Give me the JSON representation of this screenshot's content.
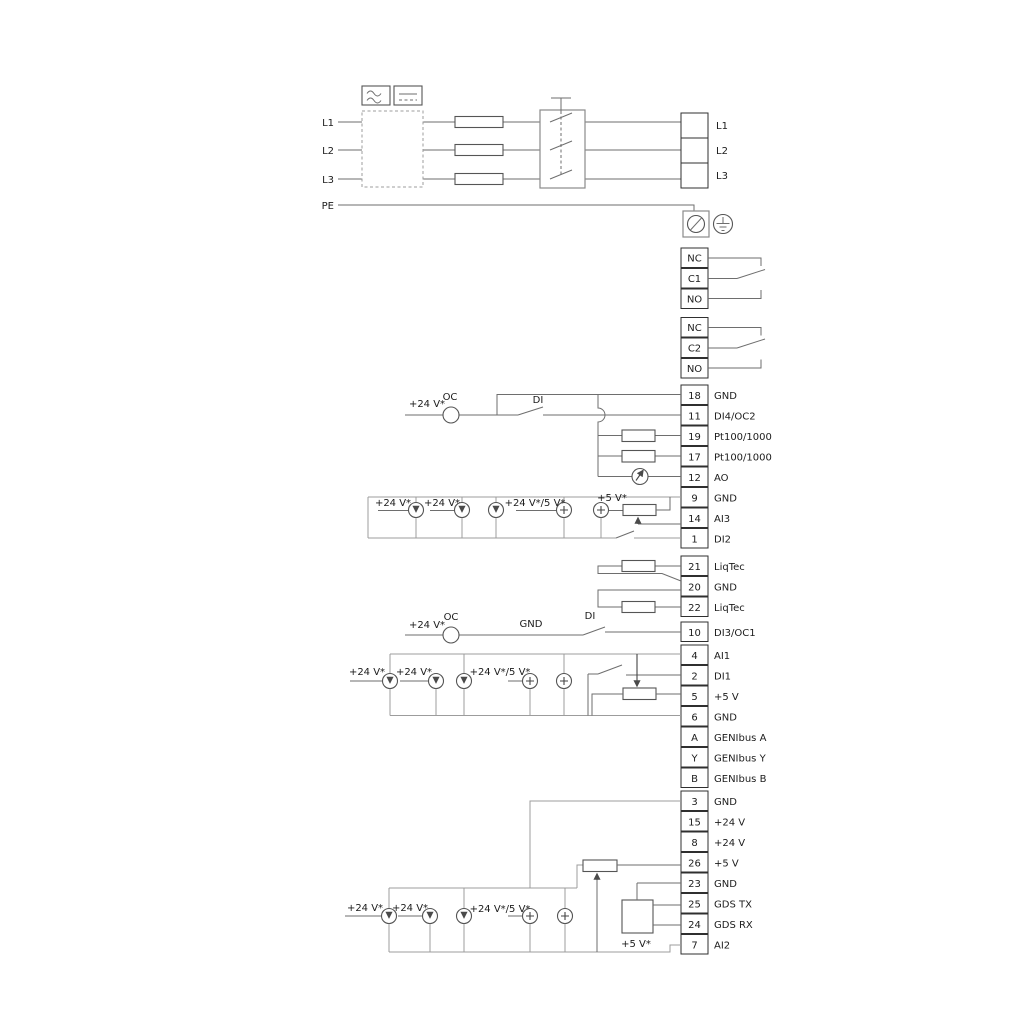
{
  "mains": {
    "input_labels": [
      "L1",
      "L2",
      "L3",
      "PE"
    ],
    "output_labels": [
      "L1",
      "L2",
      "L3"
    ]
  },
  "relays": {
    "r1": [
      "NC",
      "C1",
      "NO"
    ],
    "r2": [
      "NC",
      "C2",
      "NO"
    ]
  },
  "terminals": {
    "io_top": [
      {
        "num": "18",
        "label": "GND"
      },
      {
        "num": "11",
        "label": "DI4/OC2"
      },
      {
        "num": "19",
        "label": "Pt100/1000"
      },
      {
        "num": "17",
        "label": "Pt100/1000"
      },
      {
        "num": "12",
        "label": "AO"
      }
    ],
    "io_ai3": [
      {
        "num": "9",
        "label": "GND"
      },
      {
        "num": "14",
        "label": "AI3"
      },
      {
        "num": "1",
        "label": "DI2"
      }
    ],
    "io_liqtec": [
      {
        "num": "21",
        "label": "LiqTec"
      },
      {
        "num": "20",
        "label": "GND"
      },
      {
        "num": "22",
        "label": "LiqTec"
      }
    ],
    "io_di3": [
      {
        "num": "10",
        "label": "DI3/OC1"
      }
    ],
    "io_ai1": [
      {
        "num": "4",
        "label": "AI1"
      },
      {
        "num": "2",
        "label": "DI1"
      },
      {
        "num": "5",
        "label": "+5 V"
      },
      {
        "num": "6",
        "label": "GND"
      },
      {
        "num": "A",
        "label": "GENIbus A"
      },
      {
        "num": "Y",
        "label": "GENIbus Y"
      },
      {
        "num": "B",
        "label": "GENIbus B"
      }
    ],
    "io_ai2": [
      {
        "num": "3",
        "label": "GND"
      },
      {
        "num": "15",
        "label": "+24 V"
      },
      {
        "num": "8",
        "label": "+24 V"
      },
      {
        "num": "26",
        "label": "+5 V"
      },
      {
        "num": "23",
        "label": "GND"
      },
      {
        "num": "25",
        "label": "GDS TX"
      },
      {
        "num": "24",
        "label": "GDS RX"
      },
      {
        "num": "7",
        "label": "AI2"
      }
    ]
  },
  "ann": {
    "g1": {
      "v24": "+24 V*",
      "oc": "OC",
      "di": "DI"
    },
    "ai3": {
      "v24a": "+24 V*",
      "v24b": "+24 V*",
      "v245": "+24 V*/5 V*",
      "v5": "+5 V*"
    },
    "g10": {
      "v24": "+24 V*",
      "oc": "OC",
      "gnd": "GND",
      "di": "DI"
    },
    "ai1": {
      "v24a": "+24 V*",
      "v24b": "+24 V*",
      "v245": "+24 V*/5 V*"
    },
    "ai2": {
      "v24a": "+24 V*",
      "v24b": "+24 V*",
      "v245": "+24 V*/5 V*",
      "v5": "+5 V*"
    }
  }
}
